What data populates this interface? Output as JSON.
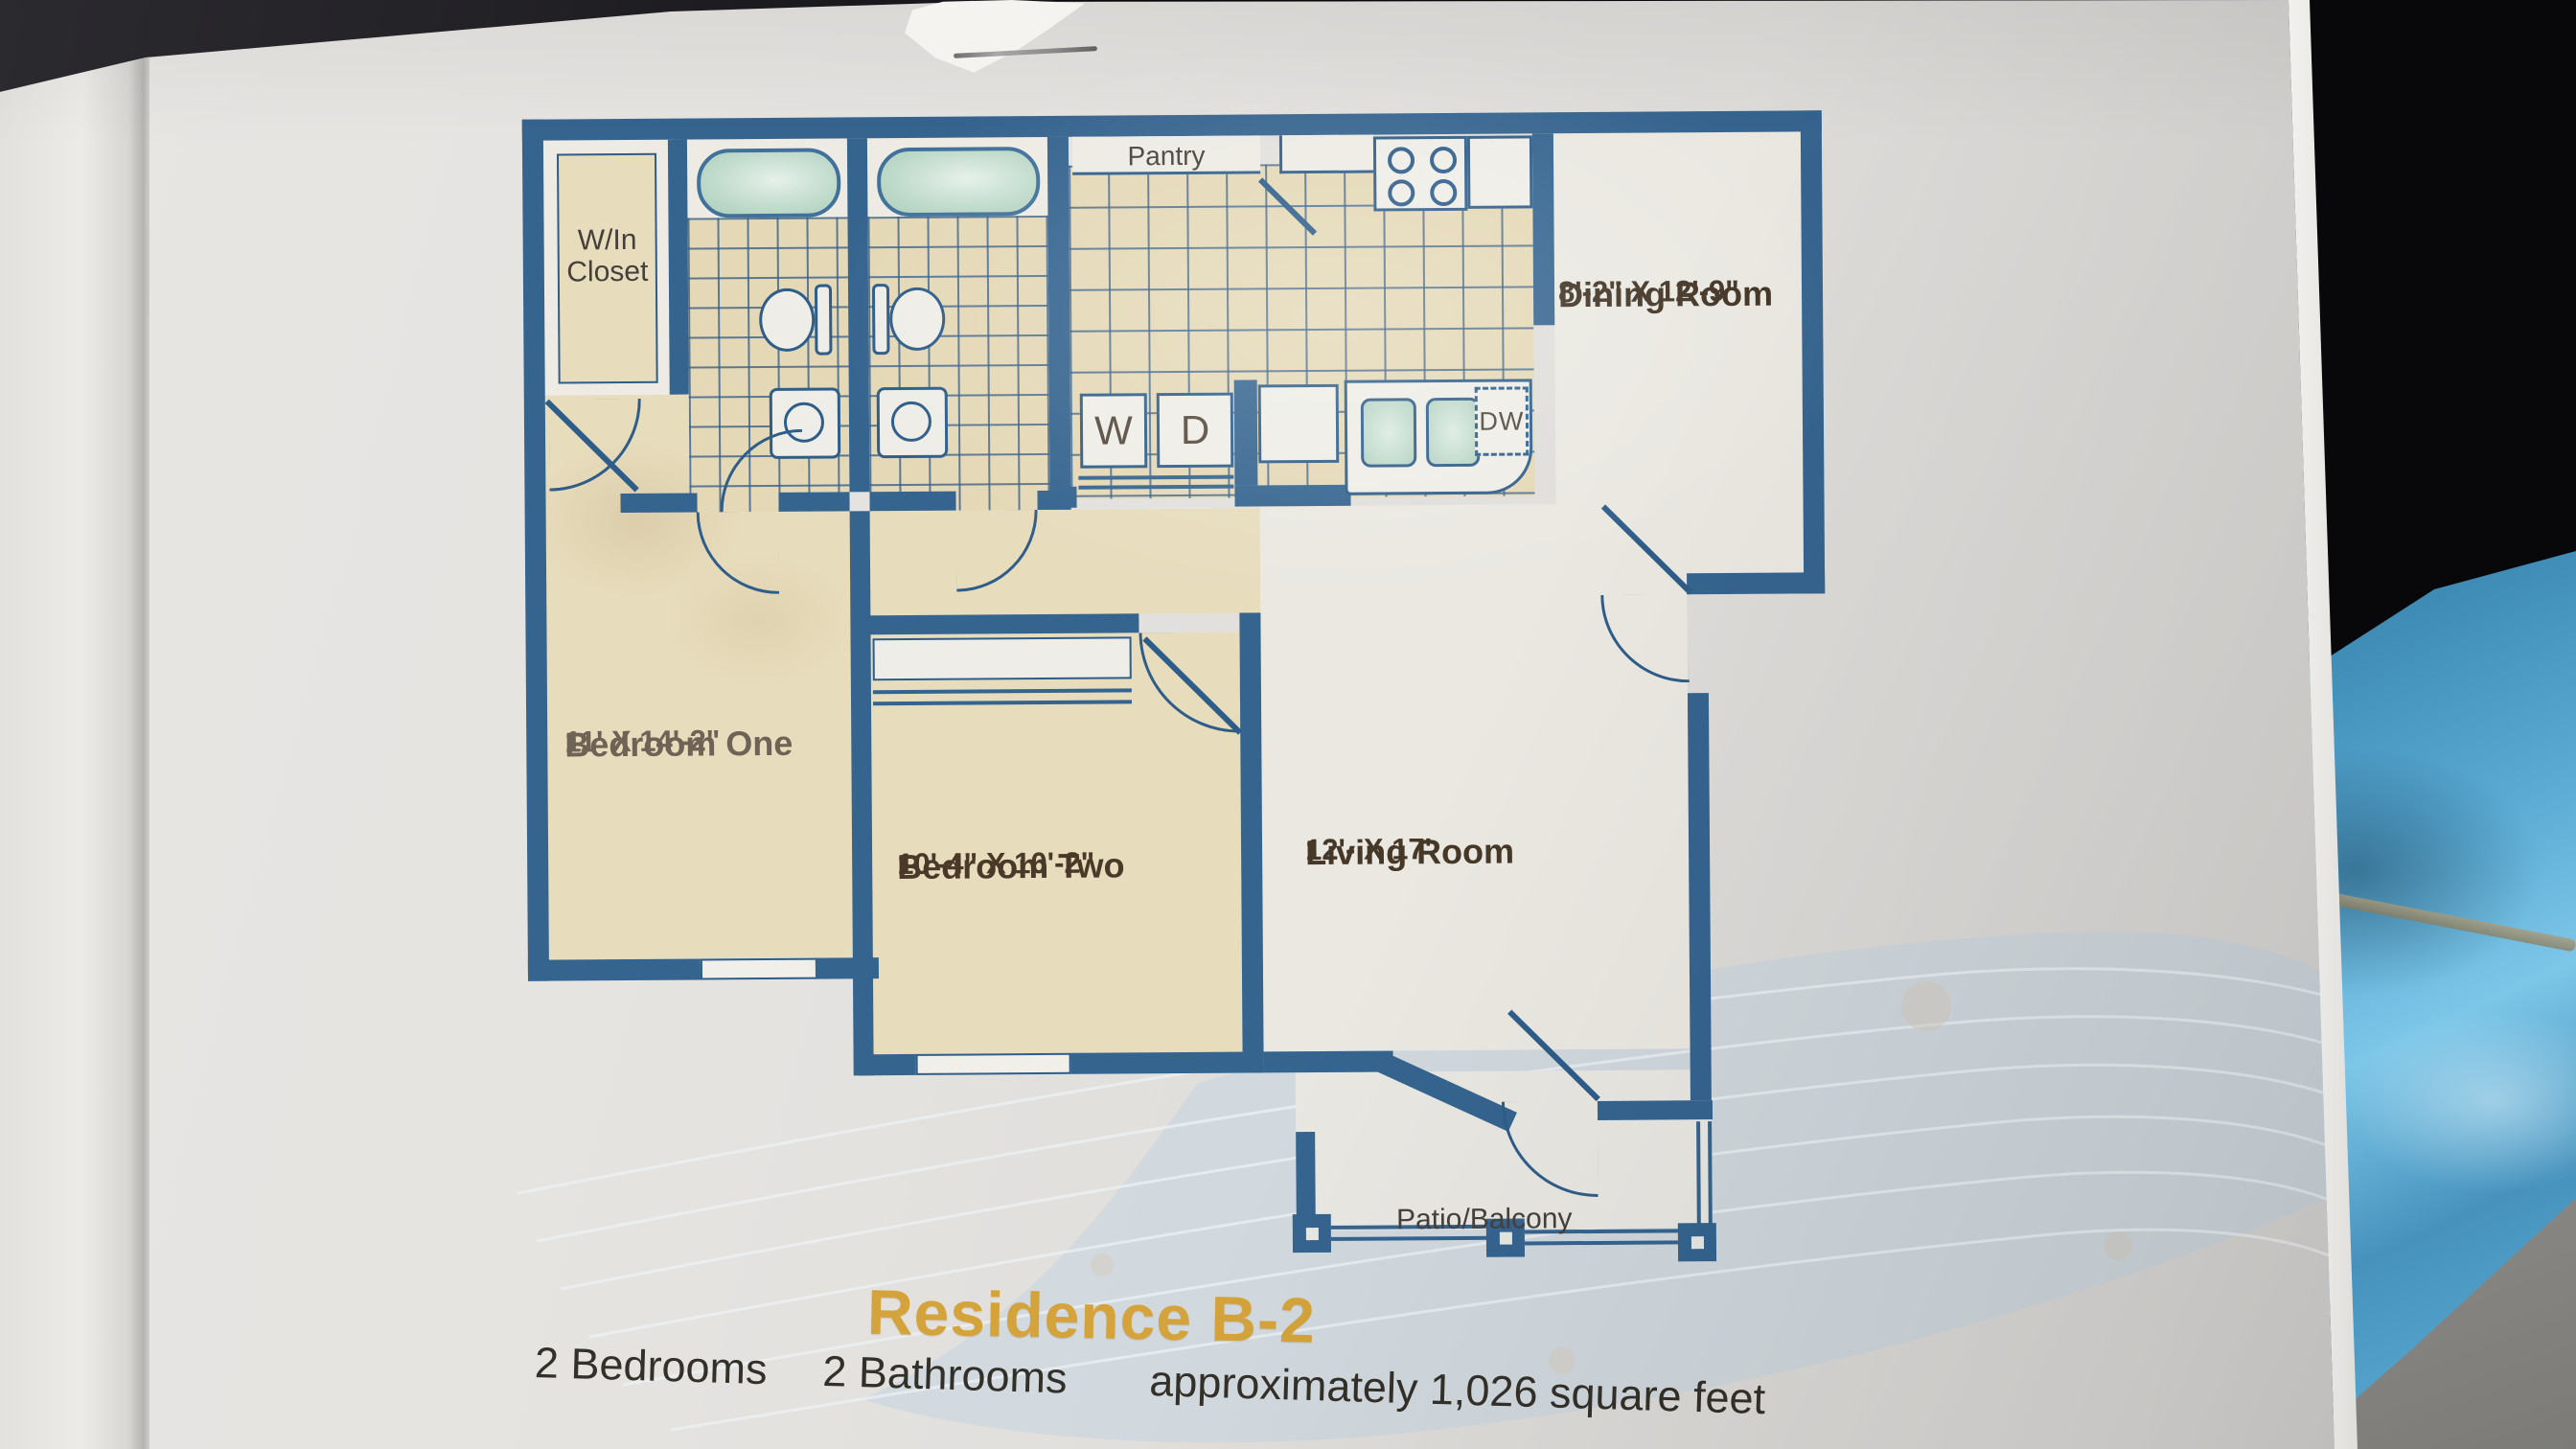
{
  "brochure": {
    "floorplan": {
      "rooms": {
        "walk_in_closet": {
          "label": "W/In\nCloset"
        },
        "pantry": {
          "label": "Pantry"
        },
        "dining_room": {
          "name": "Dining Room",
          "dims": "8'-2\" X 12'-9\""
        },
        "bedroom_one": {
          "name": "Bedroom One",
          "dims": "11' X 14'-2\""
        },
        "bedroom_two": {
          "name": "Bedroom Two",
          "dims": "10'-4\" X 10'-2\""
        },
        "living_room": {
          "name": "Living Room",
          "dims": "12'- X 17'"
        },
        "patio": {
          "label": "Patio/Balcony"
        }
      },
      "appliances": {
        "washer": "W",
        "dryer": "D",
        "dishwasher": "DW"
      }
    },
    "footer": {
      "title": "Residence B-2",
      "specs": [
        "2 Bedrooms",
        "2 Bathrooms",
        "approximately 1,026 square feet"
      ]
    }
  },
  "colors": {
    "wall_blue": "#35648f",
    "tile_beige": "#e4d8b6",
    "room_cream": "#e7dcbc",
    "room_white": "#edebe4",
    "tub_green": "#bcd9c8",
    "title_gold": "#d4a33b",
    "fabric_blue": "#55a7d4"
  }
}
